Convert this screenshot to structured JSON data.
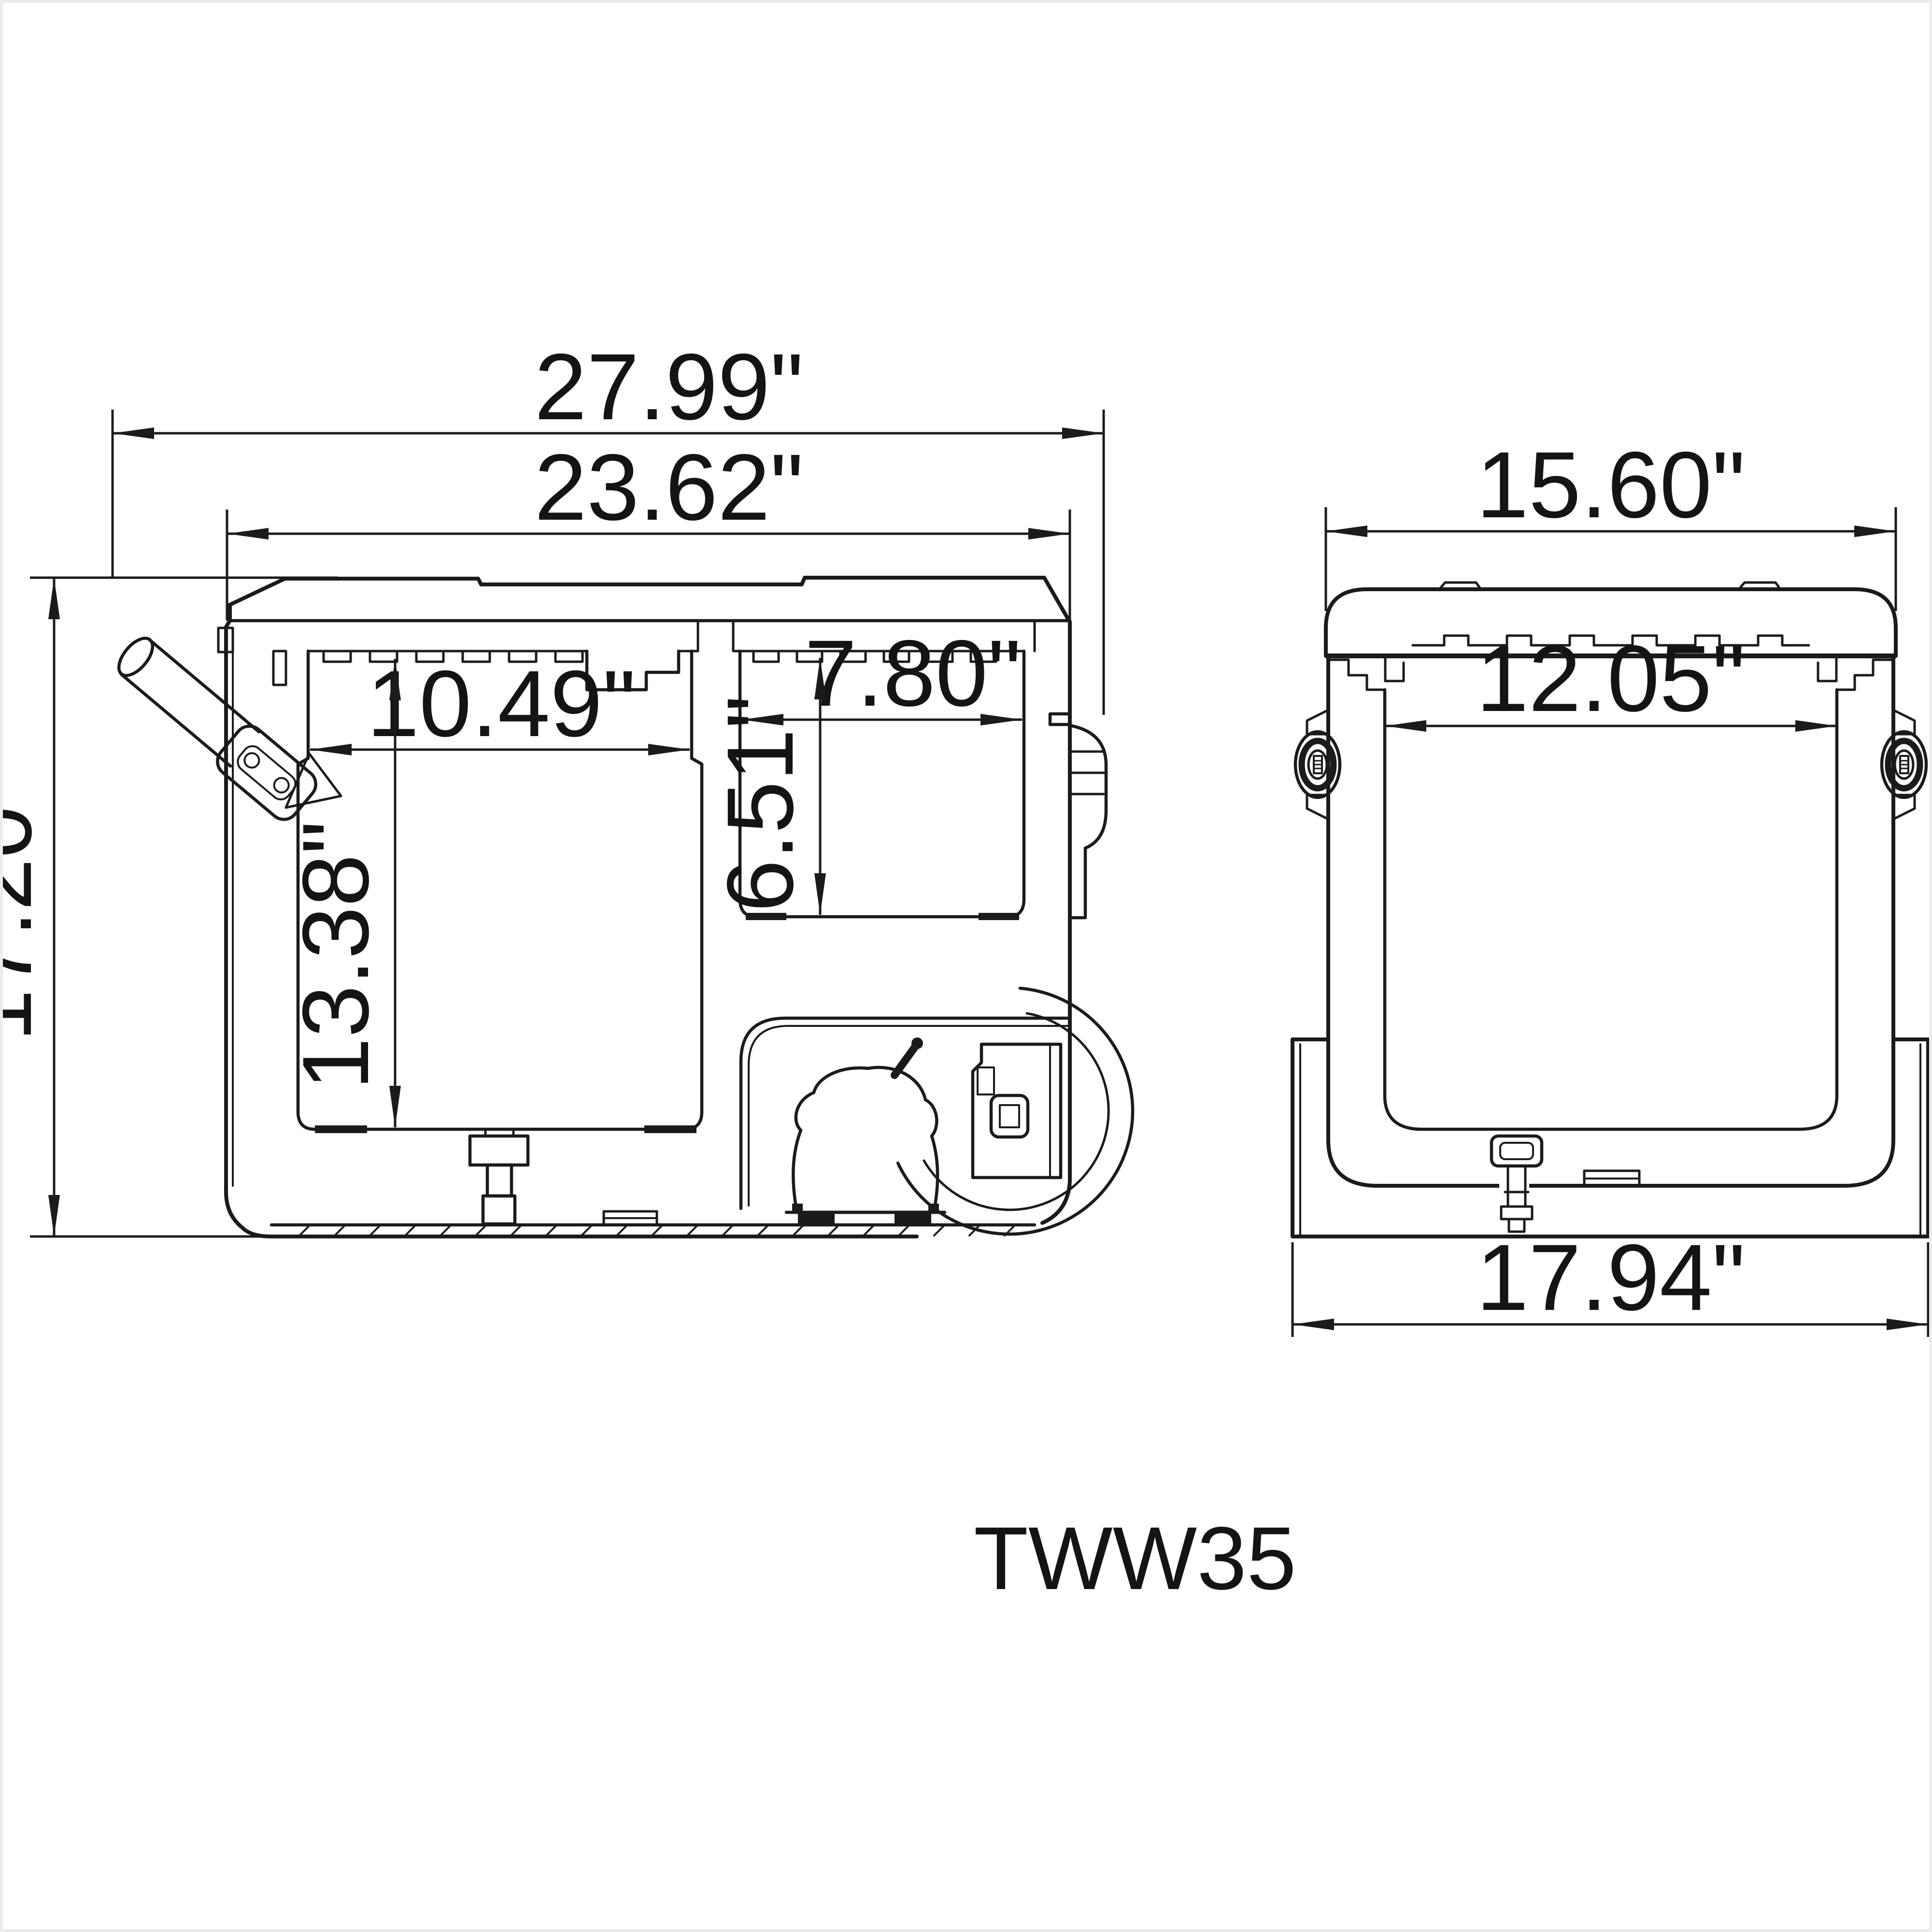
{
  "colors": {
    "line": "#1b1b1b",
    "background": "#ffffff"
  },
  "model_label": "TWW35",
  "side_view": {
    "dims": {
      "overall_width": "27.99\"",
      "lid_width": "23.62\"",
      "overall_height": "17.20\"",
      "main_compartment_width": "10.49\"",
      "main_compartment_depth": "13.38\"",
      "small_compartment_width": "7.80\"",
      "small_compartment_depth": "6.51\""
    }
  },
  "end_view": {
    "dims": {
      "top_width": "15.60\"",
      "interior_width": "12.05\"",
      "base_width": "17.94\""
    }
  }
}
